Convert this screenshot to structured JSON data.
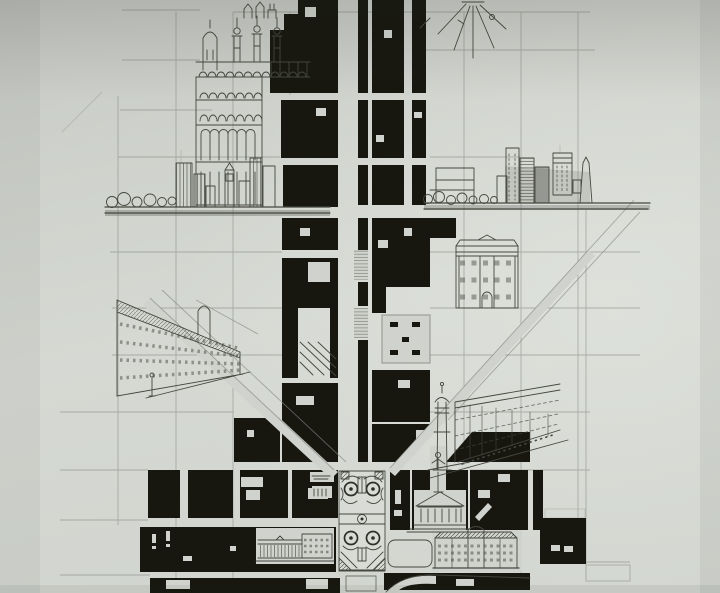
{
  "drawing": {
    "kind": "Photograph of a hand-drawn urban master plan: ink figure-ground city blocks along a central axis with pencil street grid, diagonal avenues, skyline elevations and perspective sketches",
    "elements": [
      "pencil-street-grid",
      "figure-ground-city-blocks",
      "central-axis-boulevard",
      "diagonal-avenues",
      "ornamental-garden-parterre",
      "skyline-elevation-left",
      "skyline-elevation-right",
      "ornate-towers-building-sketch",
      "etoile-radial-plaza-sketch",
      "palazzo-facade-sketch",
      "boulevard-perspective-sketch-left",
      "boulevard-perspective-sketch-right",
      "lighthouse-tower-sketch",
      "domed-temple-statue-sketch",
      "palace-elevation-sketch",
      "colonnade-elevation-sketch",
      "rounded-plaza",
      "courtyard-building-plan"
    ]
  },
  "colors": {
    "paper": "#d0d3cd",
    "paper_light": "#d9dcd6",
    "ink": "#17170f",
    "pencil": "#82857f",
    "sketch": "#45473f",
    "wash": "#50524d"
  }
}
